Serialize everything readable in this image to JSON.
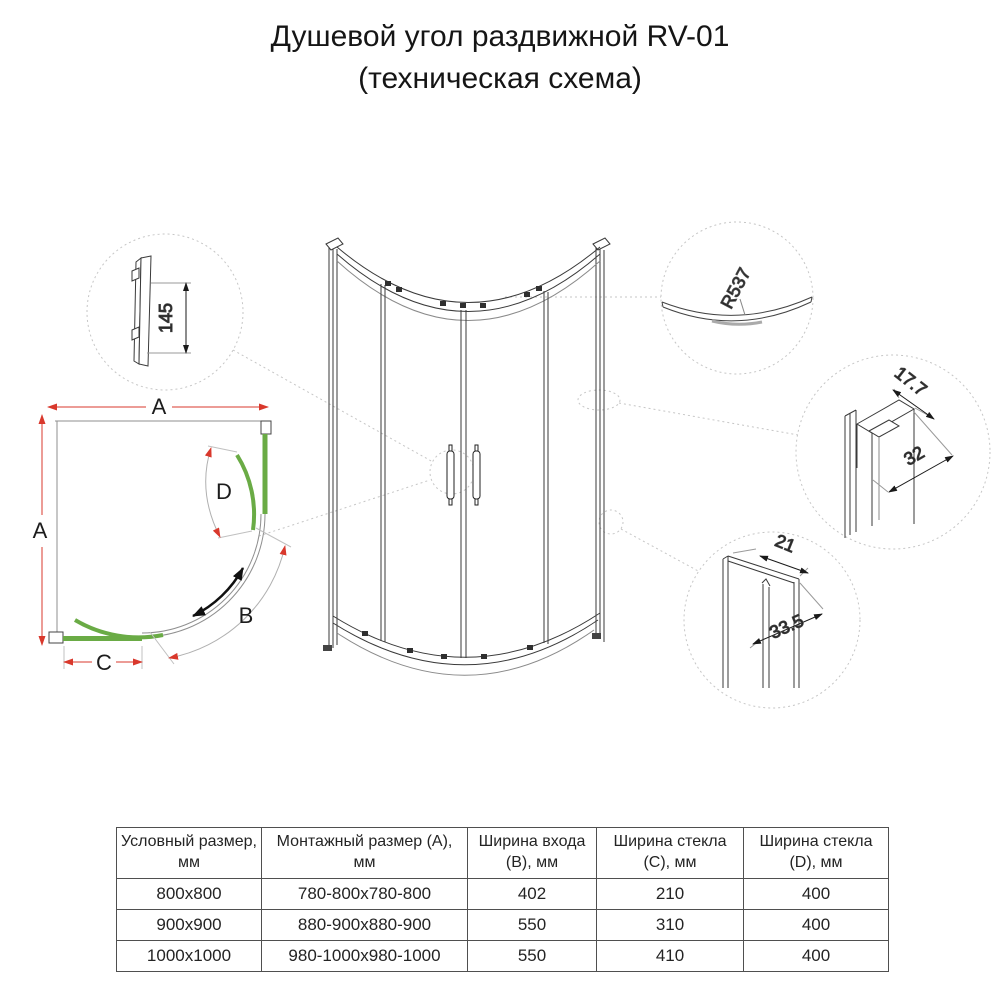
{
  "title": {
    "line1": "Душевой угол раздвижной RV-01",
    "line2": "(техническая схема)"
  },
  "plan": {
    "dim_a_top": "A",
    "dim_a_left": "A",
    "dim_b": "B",
    "dim_c": "C",
    "dim_d": "D"
  },
  "details": {
    "handle_height": "145",
    "curve_radius": "R537",
    "wall_profile_depth": "17.7",
    "wall_profile_width": "32",
    "corner_profile_width": "21",
    "corner_profile_depth": "33.5"
  },
  "table": {
    "headers": [
      "Условный размер, мм",
      "Монтажный размер (A), мм",
      "Ширина входа (B), мм",
      "Ширина стекла (C), мм",
      "Ширина стекла (D), мм"
    ],
    "rows": [
      [
        "800x800",
        "780-800x780-800",
        "402",
        "210",
        "400"
      ],
      [
        "900x900",
        "880-900x880-900",
        "550",
        "310",
        "400"
      ],
      [
        "1000x1000",
        "980-1000x980-1000",
        "550",
        "410",
        "400"
      ]
    ]
  },
  "colors": {
    "glass_green": "#6aab45",
    "dimension_red": "#d9382c",
    "line_dark": "#3a3a3a",
    "detail_circle_gray": "#c6c6c6"
  }
}
